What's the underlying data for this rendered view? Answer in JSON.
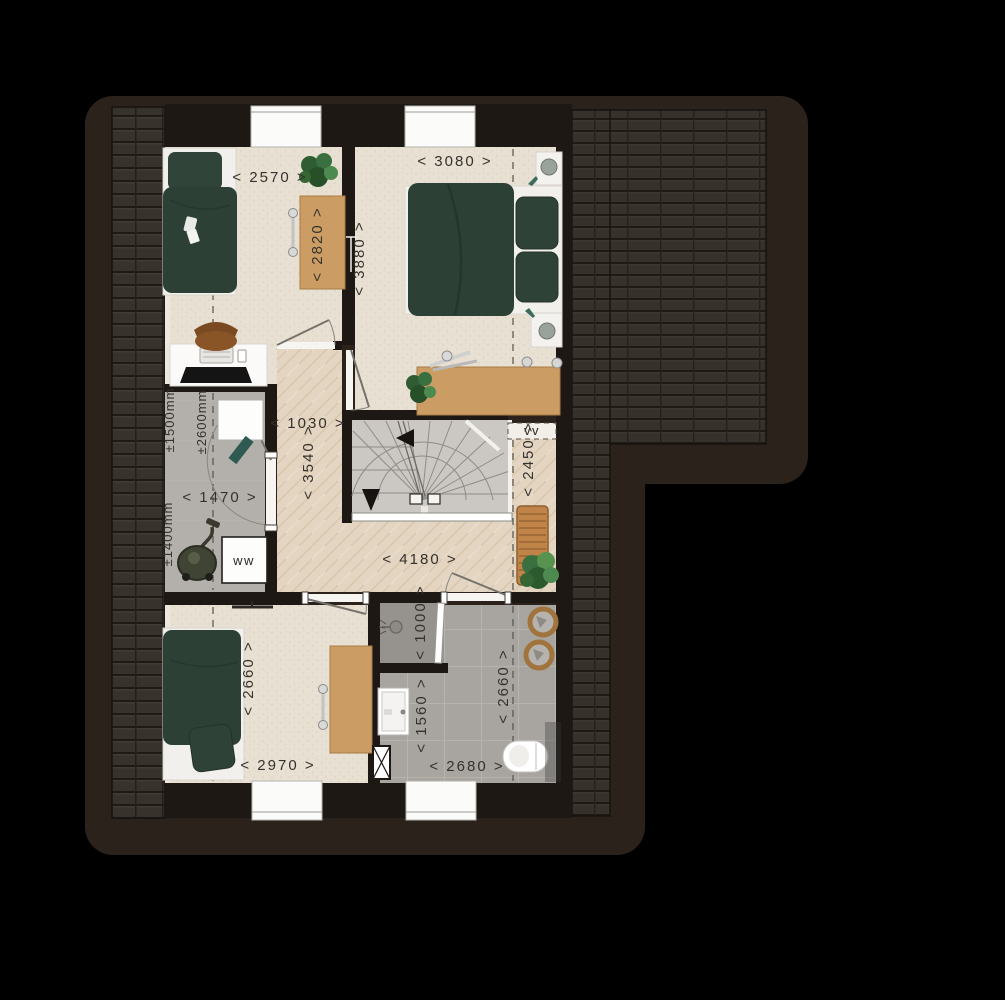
{
  "plan": {
    "dims": {
      "bedroom1_width": "< 2570 >",
      "bedroom1_depth": "< 2820 >",
      "master_width": "< 3080 >",
      "master_depth": "< 3880 >",
      "hall_width": "< 1030 >",
      "hall_depth": "< 3540 >",
      "stair_side_depth": "< 2450 >",
      "utility_width": "< 1470 >",
      "landing_width": "< 4180 >",
      "bedroom3_depth": "< 2660 >",
      "bedroom3_width": "< 2970 >",
      "shower_width": "< 1000 >",
      "bath_sink_depth": "< 1560 >",
      "bath_depth": "< 2660 >",
      "bath_width": "< 2680 >"
    },
    "heights": {
      "knee_1500": "±1500mm",
      "ceiling_2600": "±2600mm",
      "knee_1400": "±1400mm"
    },
    "appliances": {
      "washer": "ww",
      "vent_unit": "vv"
    },
    "colors": {
      "background": "#000000",
      "roof_eave": "#2b221b",
      "roof_tiles": "#37322b",
      "wall": "#1d1814",
      "floor_beige": "#e8e0d2",
      "floor_wood": "#e3d5c1",
      "floor_gray": "#b3b0ab",
      "floor_bath": "#a8a5a0",
      "stairs": "#cbc8c3",
      "bedding_green": "#2d4036",
      "furniture_oak": "#cb9d64"
    }
  }
}
